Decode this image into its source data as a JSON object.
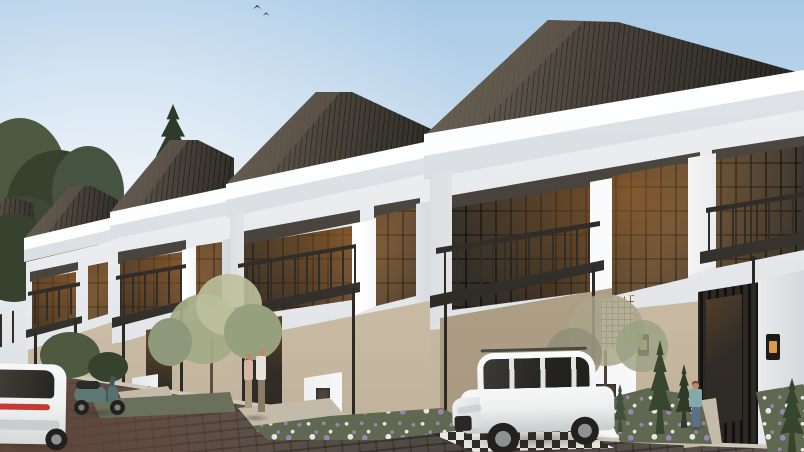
{
  "scene": {
    "description": "Daytime architectural render of a street-level row of five identical two-storey modern-classic townhouses receding to the left: dark shingled hip roofs, white cornices and pilasters, dark-framed glass walls with balconies and flat black carport canopies on slim posts, beige ground floors, flower beds with purple and white blooms, conifers, a white SUV parked in the nearest carport on a checkered apron, a white hatchback and a teal scooter at the left, a couple standing at one entry door and a single visitor at the nearest garden, all fronted by a grey-brown cobblestone street under a pale blue sky.",
    "objects": [
      "sky",
      "birds",
      "background-trees",
      "townhouse-row",
      "hip-roof",
      "cornice",
      "pilaster",
      "glass-window",
      "balcony-railing",
      "carport-canopy",
      "canopy-post",
      "entry-door",
      "breeze-block-screen",
      "gate-pillar",
      "wall-lantern",
      "mailbox-pillar",
      "flower-bed",
      "conifer",
      "front-tree",
      "cobblestone-road",
      "checker-apron",
      "white-suv",
      "white-hatchback",
      "scooter",
      "couple",
      "visitor"
    ],
    "counts": {
      "houses": 5,
      "vehicles": 3,
      "people": 3
    }
  },
  "palette": {
    "sky_top": "#a7c9e6",
    "sky_mid": "#cfe0ee",
    "sky_low": "#ecf0f1",
    "roof_dark": "#27241f",
    "roof_mid": "#453f36",
    "roof_light": "#6d6357",
    "trim_white": "#f8fafb",
    "trim_shadow": "#e2e5e9",
    "facade": "#f0f2f4",
    "facade_shade": "#dcdfe3",
    "ground_wall": "#d8cbb5",
    "ground_wall_shade": "#bfb099",
    "carport_shade": "#b3a48c",
    "window_frame": "#3a352e",
    "glass": "#2b2823",
    "railing": "#312e29",
    "canopy": "#35322d",
    "post": "#2c2a26",
    "door_dark": "#2e2a24",
    "door_glow": "#9c6630",
    "lattice": "#efe9d9",
    "lattice_line": "#756853",
    "pillar_white": "#f3f4f6",
    "road": "#7d7268",
    "road_dark": "#574f47",
    "road_red": "#5e453a",
    "curb": "#cfc8ba",
    "path": "#c3baa9",
    "grass": "#5f6850",
    "foliage_dark": "#36422e",
    "foliage_mid": "#4d5a40",
    "foliage_sage": "#a3ab86",
    "foliage_pale": "#bcc09c",
    "flower_purple": "#9d82b4",
    "flower_white": "#e7e6df",
    "car_white": "#eef0f0",
    "car_shade": "#c6cbcc",
    "tyre": "#23211e",
    "rim": "#8e9194",
    "scooter": "#5e7878",
    "taillight": "#c43b35",
    "skin": "#bb8a66",
    "shirt_white": "#e6e1d6",
    "shirt_pink": "#d8b3a8",
    "shirt_teal": "#82aaad",
    "pants_khaki": "#ab9a7e",
    "jeans": "#5d6f8a",
    "lantern": "#1e1c19",
    "lantern_glow": "#d99a4e",
    "bird": "#4a4a4a",
    "shadow_col": "rgba(40,35,30,0.38)"
  }
}
